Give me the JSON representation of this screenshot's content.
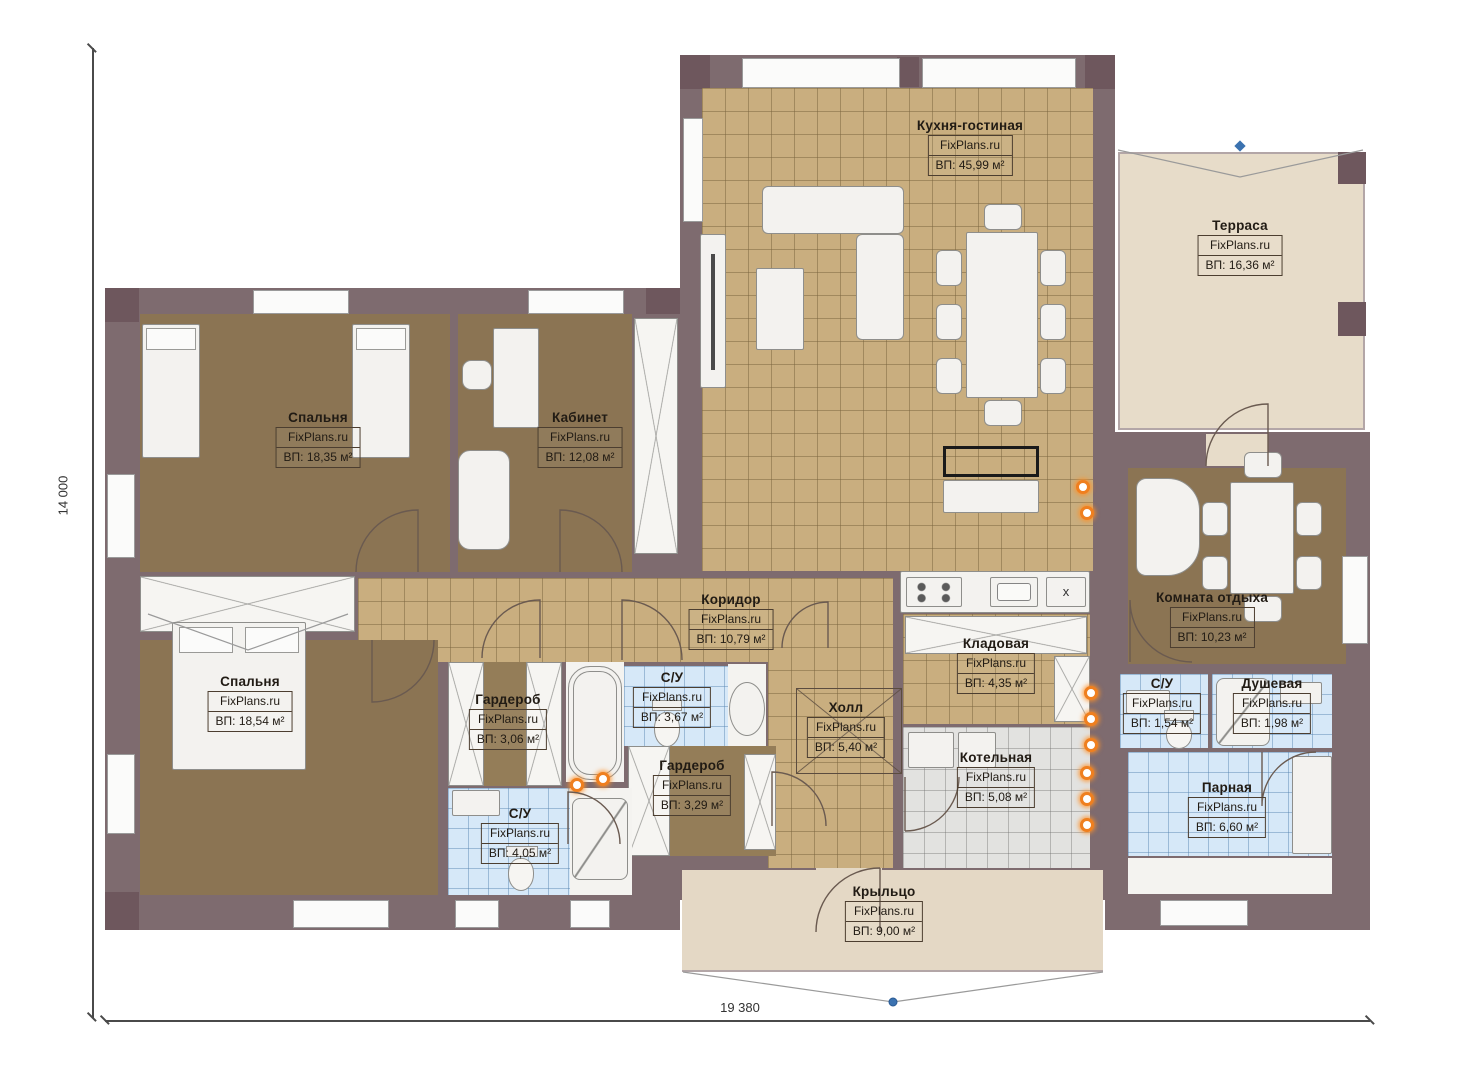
{
  "plan": {
    "watermark": "FixPlans.ru",
    "dimensions": {
      "height": "14 000",
      "width": "19 380"
    },
    "counter_mark": "x",
    "rooms": [
      {
        "id": "kitchen",
        "name": "Кухня-гостиная",
        "area": "ВП: 45,99 м²"
      },
      {
        "id": "terrace",
        "name": "Терраса",
        "area": "ВП: 16,36 м²"
      },
      {
        "id": "bedroom1",
        "name": "Спальня",
        "area": "ВП: 18,35 м²"
      },
      {
        "id": "office",
        "name": "Кабинет",
        "area": "ВП: 12,08 м²"
      },
      {
        "id": "corridor",
        "name": "Коридор",
        "area": "ВП: 10,79 м²"
      },
      {
        "id": "bedroom2",
        "name": "Спальня",
        "area": "ВП: 18,54 м²"
      },
      {
        "id": "wardrobe1",
        "name": "Гардероб",
        "area": "ВП: 3,06 м²"
      },
      {
        "id": "bath1",
        "name": "С/У",
        "area": "ВП: 3,67 м²"
      },
      {
        "id": "hall",
        "name": "Холл",
        "area": "ВП: 5,40 м²"
      },
      {
        "id": "pantry",
        "name": "Кладовая",
        "area": "ВП: 4,35 м²"
      },
      {
        "id": "boiler",
        "name": "Котельная",
        "area": "ВП: 5,08 м²"
      },
      {
        "id": "wardrobe2",
        "name": "Гардероб",
        "area": "ВП: 3,29 м²"
      },
      {
        "id": "bath2",
        "name": "С/У",
        "area": "ВП: 4,05 м²"
      },
      {
        "id": "lounge",
        "name": "Комната отдыха",
        "area": "ВП: 10,23 м²"
      },
      {
        "id": "bath3",
        "name": "С/У",
        "area": "ВП: 1,54 м²"
      },
      {
        "id": "shower",
        "name": "Душевая",
        "area": "ВП: 1,98 м²"
      },
      {
        "id": "steam",
        "name": "Парная",
        "area": "ВП: 6,60 м²"
      },
      {
        "id": "porch",
        "name": "Крыльцо",
        "area": "ВП: 9,00 м²"
      }
    ],
    "colors": {
      "wall": "#7e6b6f",
      "floor_wood": "#8b7453",
      "floor_tile_beige": "#c9ae7f",
      "floor_tile_blue": "#d6e8f8",
      "floor_tile_gray": "#e2e2e0",
      "terrace_floor": "#e7dcc9",
      "socket_orange": "#ef7f1f",
      "marker_blue": "#3b72b0"
    }
  }
}
